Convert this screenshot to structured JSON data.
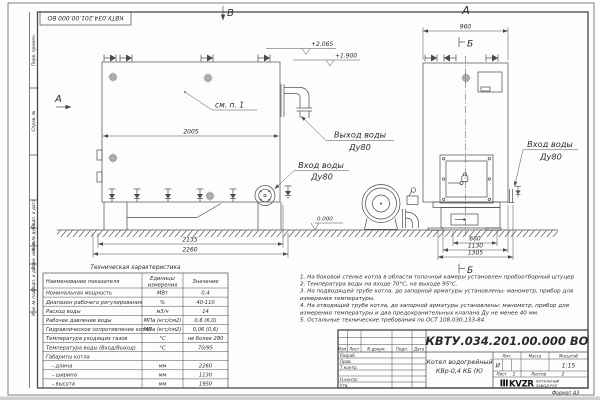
{
  "sheet": {
    "stamp_number": "КВТУ.034.201.00.000  ВО",
    "format_label": "Формат  А3",
    "margin_labels": [
      "Перв. примен.",
      "Справ. №",
      "Подп. и дата",
      "Инв. № дубл.",
      "Взам. инв. №",
      "Подп. и дата",
      "Инв. № подл."
    ]
  },
  "drawing": {
    "view_b": "В",
    "view_a_side": "А",
    "view_a_arrow": "А",
    "section_b_top": "Б",
    "section_b_bottom": "Б",
    "see_note": "см. п. 1",
    "elev_top": "+2.065",
    "elev_mid": "+1.900",
    "elev_zero": "0.000",
    "outlet_line1": "Выход воды",
    "outlet_line2": "Ду80",
    "inlet_line1": "Вход воды",
    "inlet_line2": "Ду80",
    "dims": {
      "front_body": "2005",
      "front_base": "2135",
      "front_total": "2260",
      "side_top": "960",
      "side_1": "660",
      "side_2": "1130",
      "side_3": "1305"
    }
  },
  "tech_table": {
    "title": "Техническая характеристика",
    "header_name": "Наименование показателя",
    "header_unit_1": "Единицы",
    "header_unit_2": "измерения",
    "header_value": "Значение",
    "rows": [
      [
        "Номинальная мощность",
        "МВт",
        "0,4"
      ],
      [
        "Диапазон рабочего регулирования",
        "%",
        "40-110"
      ],
      [
        "Расход воды",
        "м3/ч",
        "14"
      ],
      [
        "Рабочее давление воды",
        "МПа (кгс/см2)",
        "0,6 (6,0)"
      ],
      [
        "Гидравлическое сопротивление котла",
        "МПа (кгс/см2)",
        "0,06 (0,6)"
      ],
      [
        "Температура уходящих газов",
        "°С",
        "не более 280"
      ],
      [
        "Температура воды (Вход/Выход)",
        "°С",
        "70/95"
      ],
      [
        "Габариты котла",
        "",
        ""
      ],
      [
        "- длина",
        "мм",
        "2260"
      ],
      [
        "- ширина",
        "мм",
        "1130"
      ],
      [
        "- высота",
        "мм",
        "1950"
      ]
    ]
  },
  "notes": {
    "lines": [
      "1.  На боковой стенке котла в области топочной камеры установлен пробоотборный штуцер",
      "2.  Температура воды на входе 70°С, на выходе 95°С.",
      "3.  На подводящей трубе котла, до запорной арматуры установлены: манометр, прибор для",
      "измерения температуры.",
      "4.  На отводящей трубе котла, до запорной арматуры установлены: манометр, прибор для",
      "измерения температуры и два предохранительных клапана Ду не менее 40 мм.",
      "5.  Остальные технические требования по ОСТ 108.030.133-84."
    ]
  },
  "title_block": {
    "doc_number": "КВТУ.034.201.00.000  ВО",
    "product_line1": "Котел водогрейный",
    "product_line2": "КВр-0,4  КБ  (К)",
    "col_izm": "Изм.",
    "col_list": "Лист",
    "col_doc": "N докум.",
    "col_podp": "Подп.",
    "col_data": "Дата",
    "row_labels": [
      "Разраб.",
      "Пров.",
      "Т.контр.",
      "Н.контр.",
      "Утв."
    ],
    "lit_label": "Лит.",
    "mass_label": "Масса",
    "scale_label": "Масштаб",
    "lit_value": "И",
    "scale_value": "1:15",
    "sheet_label": "Лист",
    "sheet_value": "1",
    "sheets_label": "Листов",
    "sheets_value": "2",
    "logo_text": "KVZR",
    "company_line1": "КОТЕЛЬНЫЙ",
    "company_line2": "ЗАВОД РЭП"
  },
  "colors": {
    "line": "#4a4a4a",
    "text": "#2b2b2b",
    "sheet": "#fdfdfc"
  }
}
